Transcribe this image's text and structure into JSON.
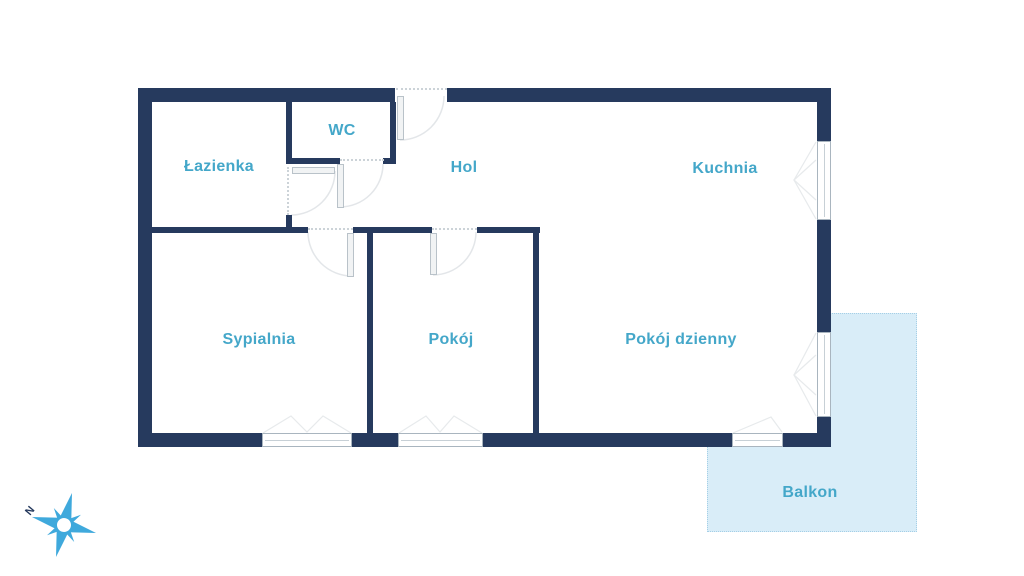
{
  "floorplan": {
    "rooms": [
      {
        "id": "lazienka",
        "label": "Łazienka"
      },
      {
        "id": "wc",
        "label": "WC"
      },
      {
        "id": "hol",
        "label": "Hol"
      },
      {
        "id": "kuchnia",
        "label": "Kuchnia"
      },
      {
        "id": "sypialnia",
        "label": "Sypialnia"
      },
      {
        "id": "pokoj",
        "label": "Pokój"
      },
      {
        "id": "pokoj-dzienny",
        "label": "Pokój dzienny"
      },
      {
        "id": "balkon",
        "label": "Balkon"
      }
    ],
    "compass": {
      "north_label": "N"
    },
    "icons": [
      "compass-star-icon"
    ],
    "colors": {
      "wall": "#263a5e",
      "room_label": "#44a7c9",
      "balcony_fill": "#d9edf8",
      "balcony_border": "#a5cfe6",
      "compass_blue": "#3fa9dc",
      "door_arc": "#e3e6e9",
      "window_line": "#a9b5bf"
    }
  }
}
